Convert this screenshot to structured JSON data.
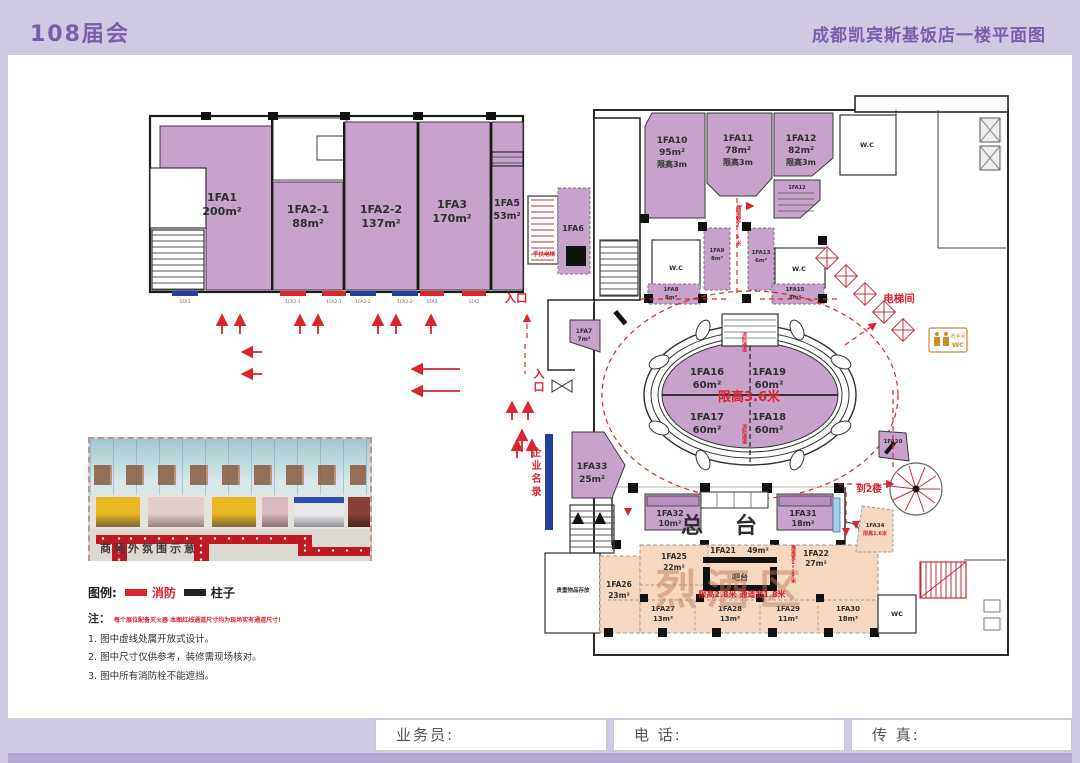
{
  "header": {
    "event": "108届会",
    "title": "成都凯宾斯基饭店一楼平面图"
  },
  "rooms": [
    {
      "id": "1FA1",
      "area": "200m²"
    },
    {
      "id": "1FA2-1",
      "area": "88m²"
    },
    {
      "id": "1FA2-2",
      "area": "137m²"
    },
    {
      "id": "1FA3",
      "area": "170m²"
    },
    {
      "id": "1FA5",
      "area": "53m²"
    },
    {
      "id": "1FA6",
      "area": ""
    },
    {
      "id": "1FA7",
      "area": "7m²"
    },
    {
      "id": "1FA10",
      "area": "95m²",
      "limit": "限高3m"
    },
    {
      "id": "1FA11",
      "area": "78m²",
      "limit": "限高3m"
    },
    {
      "id": "1FA12",
      "area": "82m²",
      "limit": "限高3m"
    },
    {
      "id": "1FA9",
      "area": "8m²"
    },
    {
      "id": "1FA13",
      "area": "6m²"
    },
    {
      "id": "1FA8",
      "area": "8m²"
    },
    {
      "id": "1FA15",
      "area": "8m²"
    },
    {
      "id": "1FA16",
      "area": "60m²"
    },
    {
      "id": "1FA19",
      "area": "60m²"
    },
    {
      "id": "1FA17",
      "area": "60m²"
    },
    {
      "id": "1FA18",
      "area": "60m²"
    },
    {
      "id": "1FA33",
      "area": "25m²"
    },
    {
      "id": "1FA32",
      "area": "10m²"
    },
    {
      "id": "1FA31",
      "area": "18m²"
    },
    {
      "id": "1FA20",
      "area": ""
    },
    {
      "id": "1FA34",
      "area": "",
      "limit": "限高1.6米"
    },
    {
      "id": "1FA25",
      "area": "22m²"
    },
    {
      "id": "1FA21",
      "area": "49m²"
    },
    {
      "id": "1FA22",
      "area": "27m²"
    },
    {
      "id": "1FA26",
      "area": "23m²"
    },
    {
      "id": "1FA27",
      "area": "13m²"
    },
    {
      "id": "1FA28",
      "area": "13m²"
    },
    {
      "id": "1FA29",
      "area": "11m²"
    },
    {
      "id": "1FA30",
      "area": "18m²"
    }
  ],
  "annotations": {
    "entrance_top": "入口",
    "entrance_left": "入口",
    "escalator": "手扶电梯",
    "elevator_hall": "电梯间",
    "to_2nd_floor": "到2楼",
    "company_directory": "企业名录",
    "front_desk": "总台",
    "bar_counter": "吧台",
    "valuables": "贵重物品存放",
    "liquor_zone": "烈酒区",
    "rotunda_limit": "限高3.6米",
    "aisle_limit": "限高2.8米 通道宽1.8米",
    "aisle_width_25": "通道宽2.5米",
    "aisle_width_18": "通道宽1.8米",
    "fire_lane": "消防通道",
    "wc": "W.C",
    "wc_short": "WC",
    "restroom": "洗手间"
  },
  "hydrant_tags": [
    "1FA1",
    "1FA2-1",
    "1FA2-1",
    "1FA2-2",
    "1FA2-2",
    "1FA3",
    "1FA5"
  ],
  "legend": {
    "title": "图例:",
    "fire": "消防",
    "pillar": "柱子"
  },
  "notes": {
    "prefix": "注：",
    "warning": "每个展位配备灭火器 本图红线通道尺寸均为现场实有通道尺寸!",
    "items": [
      "1. 图中虚线处属开放式设计。",
      "2. 图中尺寸仅供参考，装修需现场核对。",
      "3. 图中所有消防栓不能遮挡。"
    ]
  },
  "photo": {
    "caption": "商场外氛围示意"
  },
  "form": {
    "salesperson": "业务员:",
    "phone": "电 话:",
    "fax": "传 真:"
  },
  "colors": {
    "room_purple": "#c7a3cb",
    "zone_orange": "#f6d7bf",
    "accent_red": "#d9252e",
    "marker_blue": "#24409e",
    "header_purple": "#7a5fa8"
  }
}
